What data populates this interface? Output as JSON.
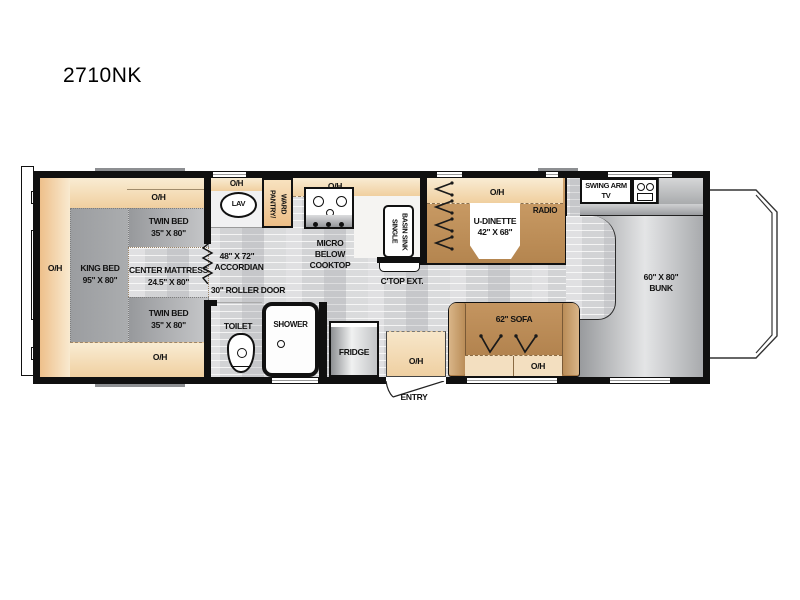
{
  "model": "2710NK",
  "common": {
    "oh": "O/H"
  },
  "bedroom": {
    "king": [
      "KING BED",
      "95\" X 80\""
    ],
    "twin": [
      "TWIN BED",
      "35\" X 80\""
    ],
    "center": [
      "CENTER MATTRESS",
      "24.5\" X 80\""
    ]
  },
  "partition": {
    "accordion_size": "48\" X 72\"",
    "accordion": "ACCORDIAN",
    "roller_door": "30\" ROLLER DOOR"
  },
  "bath": {
    "lav": "LAV",
    "toilet": "TOILET",
    "shower": "SHOWER"
  },
  "storage": {
    "pantry_line1": "PANTRY/",
    "pantry_line2": "WARD"
  },
  "kitchen": {
    "micro": [
      "MICRO",
      "BELOW",
      "COOKTOP"
    ],
    "sink_line1": "SINGLE",
    "sink_line2": "BASIN SINK",
    "ctop": "C'TOP EXT.",
    "fridge": "FRIDGE"
  },
  "dinette": {
    "name": "U-DINETTE",
    "size": "42\" X 68\"",
    "radio": "RADIO"
  },
  "living": {
    "sofa": "62\" SOFA",
    "tv_line1": "SWING ARM",
    "tv_line2": "TV"
  },
  "bunk": {
    "size": "60\" X 80\"",
    "name": "BUNK"
  },
  "entry": {
    "label": "ENTRY"
  }
}
